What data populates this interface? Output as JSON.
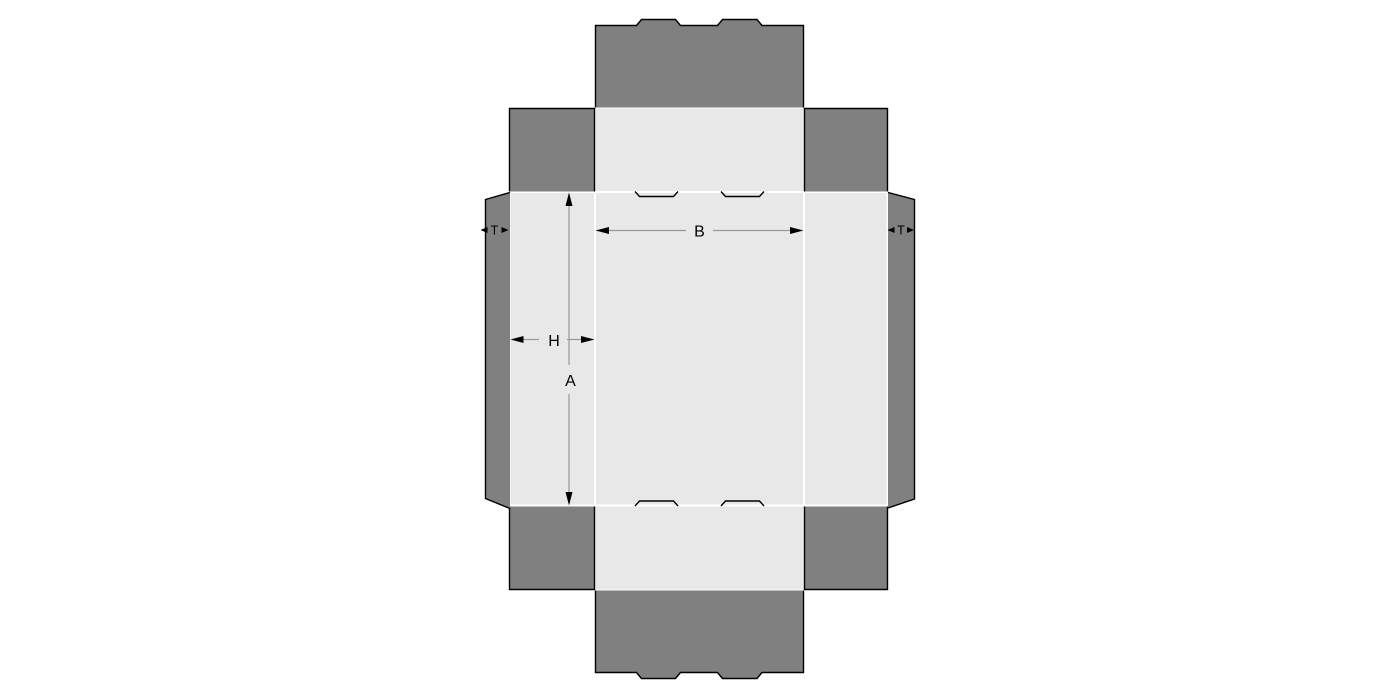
{
  "diagram": {
    "name": "box-dieline-template",
    "labels": {
      "A": "A",
      "B": "B",
      "H": "H",
      "T_left": "T",
      "T_right": "T"
    },
    "colors": {
      "panel": "#e8e8e8",
      "flap": "#808080",
      "cut_line": "#000000",
      "dimension_line": "#999999",
      "label_text": "#000000",
      "background": "#ffffff"
    }
  }
}
